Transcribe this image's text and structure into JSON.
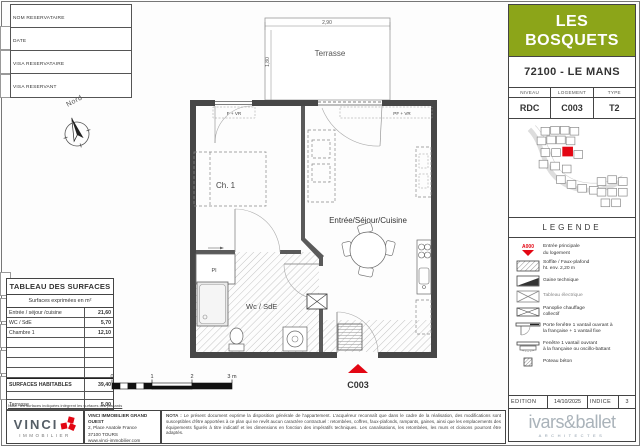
{
  "form": {
    "fields": [
      "NOM RESERVATAIRE",
      "DATE",
      "VISA RESERVATAIRE",
      "VISA RESERVANT"
    ]
  },
  "compass": {
    "label": "Nord"
  },
  "plan": {
    "terrace_label": "Terrasse",
    "terrace_width": "2,90",
    "terrace_depth": "1,80",
    "rooms": {
      "bedroom": "Ch. 1",
      "living": "Entrée/Séjour/Cuisine",
      "bathroom": "Wc / SdE",
      "closet": "Pl"
    },
    "window_left": "F + VR",
    "window_right": "PF + VR",
    "unit_code": "C003"
  },
  "scalebar": {
    "ticks": [
      "0",
      "1",
      "2",
      "3 m"
    ]
  },
  "surfaces_table": {
    "title": "TABLEAU DES SURFACES",
    "subtitle": "Surfaces exprimées en m²",
    "rows": [
      [
        "Entrée / séjour /cuisine",
        "21,60"
      ],
      [
        "WC / SdE",
        "5,70"
      ],
      [
        "Chambre 1",
        "12,10"
      ]
    ],
    "total_label": "SURFACES HABITABLES",
    "total_value": "39,40",
    "terrace_label": "Terrasse",
    "terrace_value": "5,00",
    "note": "Nota : les surfaces indiquées intègrent les surfaces des placards"
  },
  "title_block": {
    "project_line1": "LES",
    "project_line2": "BOSQUETS",
    "location": "72100 - LE MANS",
    "info_headers": [
      "NIVEAU",
      "LOGEMENT",
      "TYPE"
    ],
    "info_values": [
      "RDC",
      "C003",
      "T2"
    ]
  },
  "legend": {
    "title": "LEGENDE",
    "items": [
      {
        "code": "A000",
        "label": "Entrée principale",
        "line2": "du logement"
      },
      {
        "label": "Soffite / Faux-plafond",
        "line2": "ht. env. 2,20 m"
      },
      {
        "label": "Gaine technique",
        "line2": ""
      },
      {
        "label": "Tableau électrique",
        "line2": ""
      },
      {
        "label": "Panoplie chauffage",
        "line2": "collectif"
      },
      {
        "label": "Porte fenêtre 1 vantail ouvrant à",
        "line2": "la française + 1 vantail fixe"
      },
      {
        "label": "Fenêtre 1 vantail ouvrant",
        "line2": "à la française ou oscillo-battant"
      },
      {
        "label": "Poteau béton",
        "line2": ""
      }
    ]
  },
  "edition": {
    "label": "EDITION",
    "date": "14/10/2025",
    "indice_label": "INDICE",
    "indice_value": "3"
  },
  "architect": {
    "name": "ivars&ballet",
    "tagline": "ARCHITECTES"
  },
  "publisher": {
    "brand": "VINCI",
    "brand_sub": "IMMOBILIER",
    "company": "VINCI IMMOBILIER GRAND OUEST",
    "address_line1": "2, Place Anatole France",
    "address_line2": "37100 TOURS",
    "website": "www.vinci-immobilier.com"
  },
  "nota": {
    "title": "NOTA :",
    "body": "Le présent document exprime la disposition générale de l'appartement. L'acquéreur reconnaît que dans le cadre de la réalisation, des modifications sont susceptibles d'être apportées à ce plan qui ne revêt aucun caractère contractuel : retombées, coffres, faux-plafonds, rampants, gaines, ainsi que les emplacements des équipements figurés à titre indicatif et les dimensions en fonction des impératifs techniques. Les canalisations, les retombées, les murs et cloisons pourront être adaptés."
  },
  "colors": {
    "accent_green": "#8CA519",
    "accent_red": "#E30613"
  }
}
